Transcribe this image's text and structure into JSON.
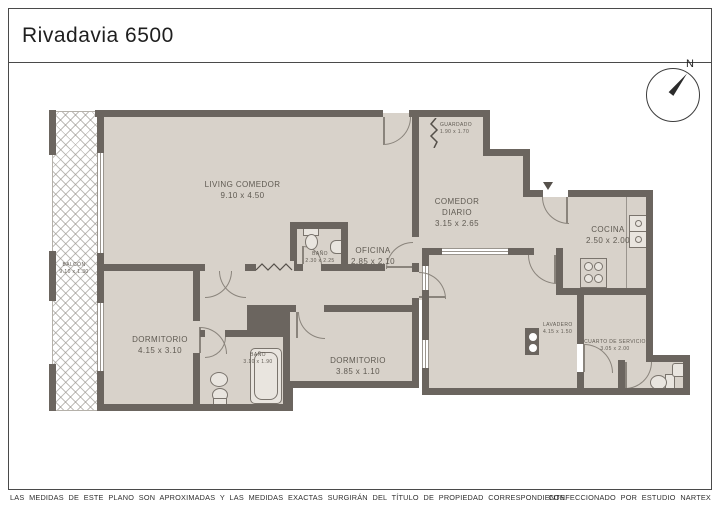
{
  "page": {
    "title": "Rivadavia 6500",
    "compass_label": "N",
    "footer_left": "LAS MEDIDAS DE ESTE PLANO SON APROXIMADAS Y LAS MEDIDAS EXACTAS SURGIRÁN DEL TÍTULO DE PROPIEDAD CORRESPONDIENTE.",
    "footer_right": "CONFECCIONADO POR ESTUDIO NARTEX"
  },
  "colors": {
    "wall": "#6b655f",
    "floor": "#d8d2ca",
    "line": "#8a847c",
    "text": "#5f5a52"
  },
  "rooms": [
    {
      "name": "LIVING COMEDOR",
      "dims": "9.10 x 4.50"
    },
    {
      "name": "BALCÓN",
      "dims": "9.10 x 1.30"
    },
    {
      "name": "GUARDADO",
      "dims": "1.90 x 1.70"
    },
    {
      "name": "COMEDOR DIARIO",
      "dims": "3.15 x 2.65"
    },
    {
      "name": "OFICINA",
      "dims": "2.85 x 2.10"
    },
    {
      "name": "BAÑO",
      "dims": "2.30 x 2.25"
    },
    {
      "name": "COCINA",
      "dims": "2.50 x 2.00"
    },
    {
      "name": "DORMITORIO",
      "dims": "4.15 x 3.10"
    },
    {
      "name": "BAÑO",
      "dims": "3.10 x 1.90"
    },
    {
      "name": "DORMITORIO",
      "dims": "3.85 x 1.10"
    },
    {
      "name": "LAVADERO",
      "dims": "4.15 x 1.50"
    },
    {
      "name": "CUARTO DE SERVICIO",
      "dims": "3.05 x 2.00"
    }
  ]
}
